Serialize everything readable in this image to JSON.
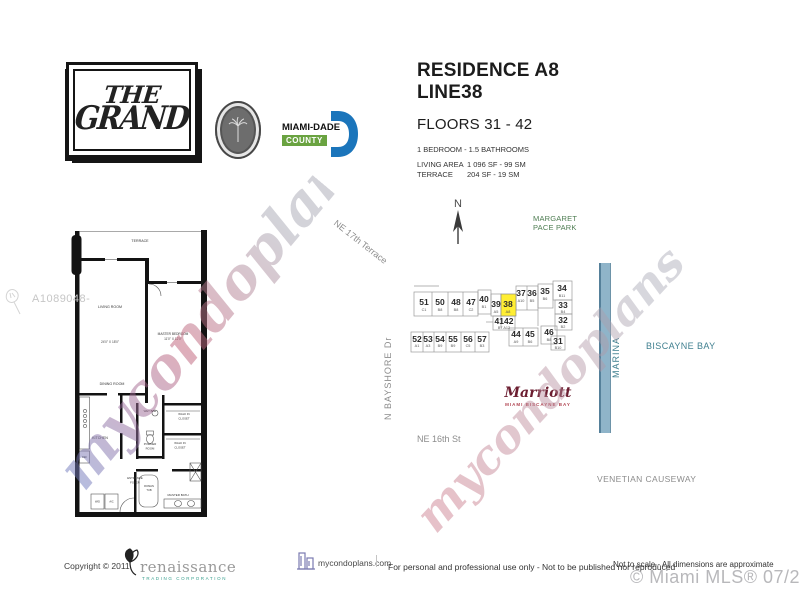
{
  "document": {
    "side_code": "A1089048-",
    "watermark": "mycondoplans"
  },
  "logos": {
    "grand_the": "THE",
    "grand_name": "GRAND",
    "miamidade_name": "MIAMI-DADE",
    "miamidade_county": "COUNTY"
  },
  "header": {
    "residence": "RESIDENCE A8",
    "line": "LINE38",
    "floors": "FLOORS 31 - 42",
    "bedrooms": "1 BEDROOM - 1.5 BATHROOMS",
    "living_area_label": "LIVING AREA",
    "living_area_value": "1 096 SF - 99 SM",
    "terrace_label": "TERRACE",
    "terrace_value": "204 SF - 19 SM"
  },
  "floorplan": {
    "labels": {
      "terrace": "TERRACE",
      "living_room": "LIVING ROOM",
      "living_dim": "24'0\" X 18'0\"",
      "master_bedroom": "MASTER BEDROOM",
      "master_dim": "11'0\" X 12'0\"",
      "dining_room": "DINING ROOM",
      "kitchen": "KITCHEN",
      "wet_bar": "WET BAR",
      "powder_l1": "POWDER",
      "powder_l2": "ROOM",
      "closet_a_l1": "WALK IN",
      "closet_a_l2": "CLOSET",
      "closet_b_l1": "WALK IN",
      "closet_b_l2": "CLOSET",
      "foyer_l1": "ENTRANCE",
      "foyer_l2": "FOYER",
      "roman_l1": "ROMAN",
      "roman_l2": "TUB",
      "master_bath": "MASTER BATH",
      "wd": "W/D",
      "ref": "REF",
      "ac": "A/C"
    }
  },
  "sitemap": {
    "compass": "N",
    "park_l1": "MARGARET",
    "park_l2": "PACE PARK",
    "street_17th": "NE 17th Terrace",
    "street_bayshore": "N BAYSHORE Dr",
    "street_16th": "NE 16th St",
    "causeway": "VENETIAN CAUSEWAY",
    "marina": "MARINA",
    "bay": "BISCAYNE BAY",
    "marriott_name": "Marriott",
    "marriott_sub": "MIAMI BISCAYNE BAY",
    "highlighted_unit": "38 A8",
    "units": [
      {
        "n": "51",
        "s": "C1"
      },
      {
        "n": "50",
        "s": "B8"
      },
      {
        "n": "48",
        "s": "B8"
      },
      {
        "n": "47",
        "s": "C2"
      },
      {
        "n": "40",
        "s": "B1"
      },
      {
        "n": "39",
        "s": "A5"
      },
      {
        "n": "38",
        "s": "A8"
      },
      {
        "n": "37",
        "s": "A10"
      },
      {
        "n": "36",
        "s": "B5"
      },
      {
        "n": "35",
        "s": "B6"
      },
      {
        "n": "34",
        "s": "B11"
      },
      {
        "n": "33",
        "s": "B4"
      },
      {
        "n": "32",
        "s": "B2"
      },
      {
        "n": "4142",
        "s": "B7 A12"
      },
      {
        "n": "44",
        "s": "A9"
      },
      {
        "n": "45",
        "s": "B6"
      },
      {
        "n": "46",
        "s": "B8"
      },
      {
        "n": "31",
        "s": "B10"
      },
      {
        "n": "52",
        "s": "A1"
      },
      {
        "n": "53",
        "s": "A3"
      },
      {
        "n": "54",
        "s": "B9"
      },
      {
        "n": "55",
        "s": "B9"
      },
      {
        "n": "56",
        "s": "C5"
      },
      {
        "n": "57",
        "s": "B3"
      }
    ]
  },
  "footer": {
    "copyright": "Copyright ©  2011",
    "renaissance_name": "renaissance",
    "renaissance_sub": "TRADING CORPORATION",
    "site": "mycondoplans.com",
    "disclaimer": "For personal and professional use only - Not to be published nor reproduced",
    "scale_note": "Not to scale - All dimensions are approximate",
    "mls": "© Miami MLS® 07/2020"
  },
  "colors": {
    "unit_highlight": "#ffee33",
    "park_green": "#4e7d52",
    "bay_teal": "#3f7f8f",
    "marriott_red": "#6b1d30",
    "miamidade_blue": "#1b75bb",
    "county_green": "#6aa341"
  }
}
